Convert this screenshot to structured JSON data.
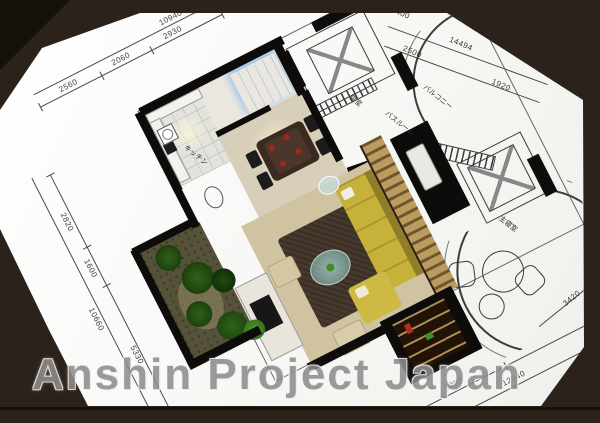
{
  "watermark": {
    "text": "Anshin Project Japan"
  },
  "plan": {
    "dims": {
      "top_total": "10940",
      "top_a": "2560",
      "top_b": "2060",
      "top_c": "2930",
      "ne_a": "2400",
      "ne_b": "2500",
      "ne_total": "14494",
      "ne_c": "1920",
      "left_a": "2820",
      "left_b": "1600",
      "left_total": "10660",
      "left_c": "5330",
      "bottom_a": "5080",
      "bottom_total": "12640",
      "right_a": "3420"
    },
    "rooms": {
      "kitchen": "キッチン",
      "balcony": "バルコニー",
      "bathroom": "バスルーム",
      "bedroom": "寝室",
      "master_bedroom": "主寝室"
    }
  },
  "colors": {
    "frame": "#2b231b",
    "frame_dark": "#16100a",
    "sheet": "#fbfaf7",
    "line": "#4a4a4a",
    "wall": "#0d0c0a",
    "sofa": "#c6b13b",
    "rug": "#47392c",
    "wood_dark": "#6e572f",
    "wood_light": "#bb9c5e",
    "floor_living": "#cfc3a2",
    "floor_hall": "#d8cfba",
    "garden": "#56523a",
    "plant": "#2f6319",
    "plant_bright": "#4f9a2e",
    "glass": "#aedcd6",
    "closet_glow": "#9cc4ea",
    "accent_red": "#a8241c",
    "watermark": "#8d8d8d"
  }
}
